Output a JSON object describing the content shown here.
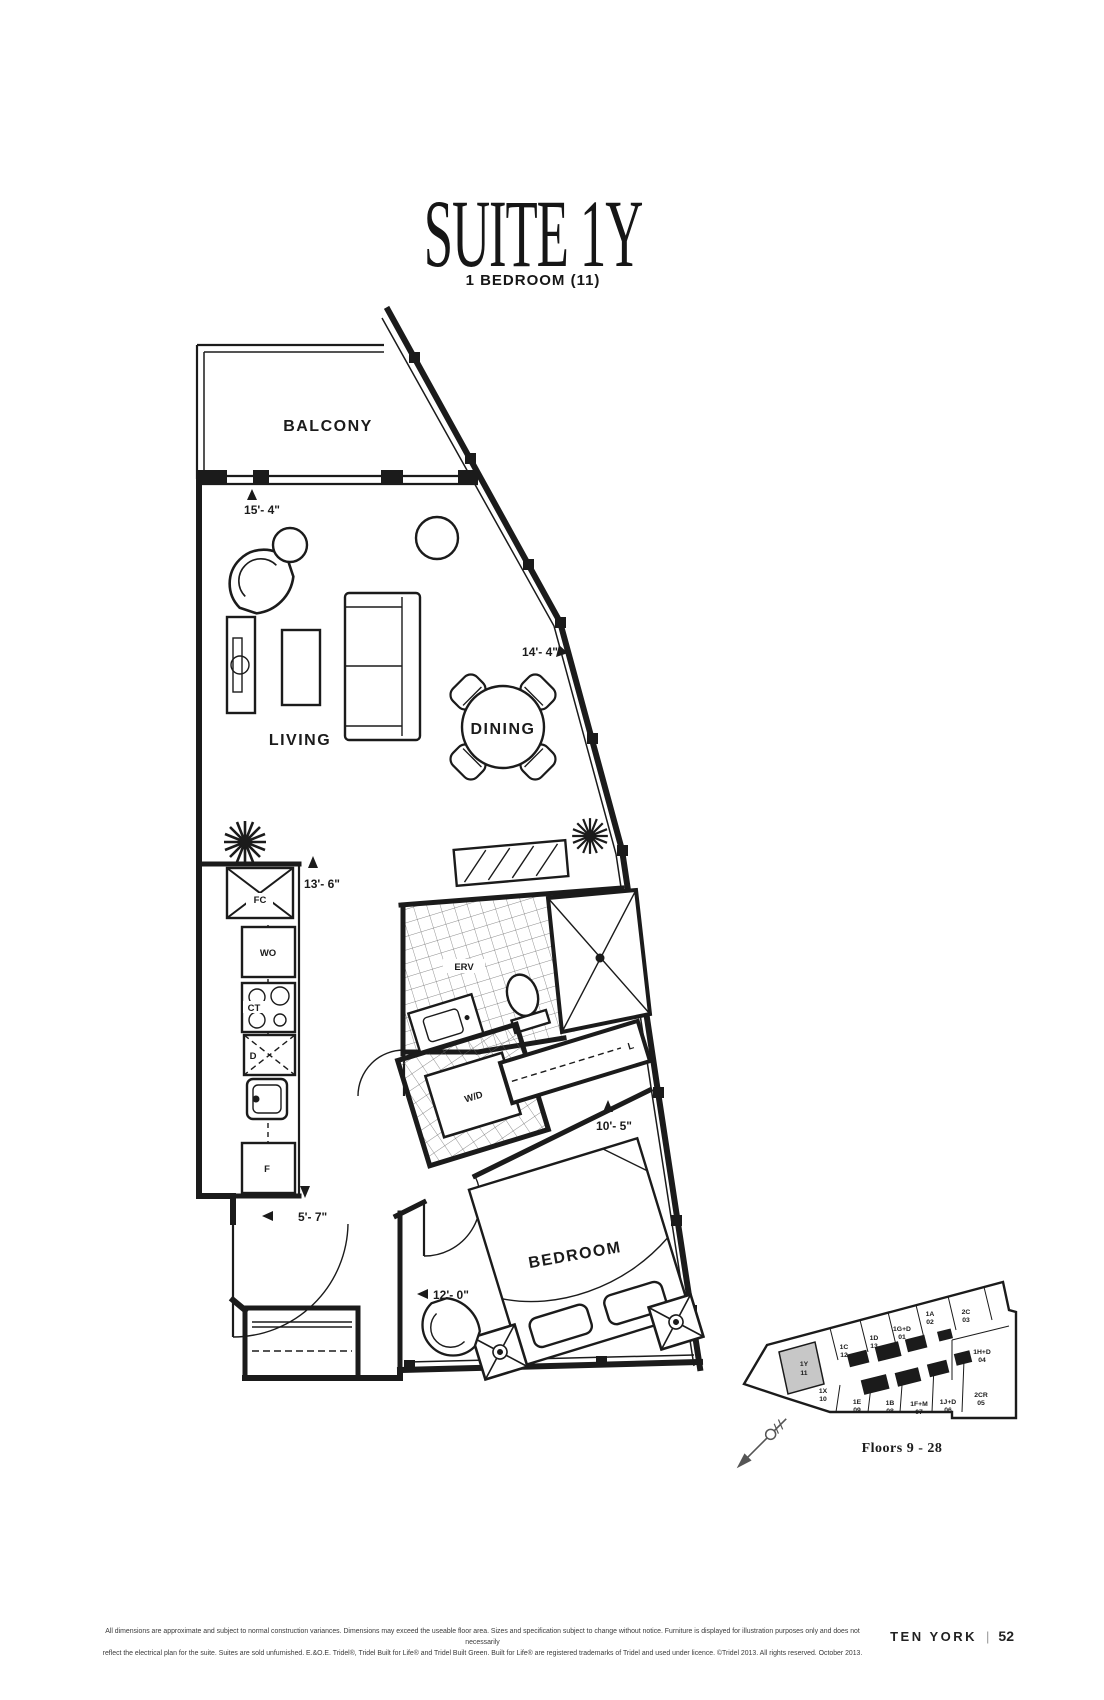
{
  "page": {
    "title": "SUITE 1Y",
    "subtitle": "1 BEDROOM (11)"
  },
  "rooms": {
    "balcony": "BALCONY",
    "living": "LIVING",
    "dining": "DINING",
    "bedroom": "BEDROOM"
  },
  "fixtures": {
    "fan_coil": "FC",
    "wall_oven": "WO",
    "cooktop": "CT",
    "dishwasher": "D",
    "fridge": "F",
    "erv": "ERV",
    "washer_dryer": "W/D",
    "linen": "L"
  },
  "dimensions": {
    "balcony_width": "15'- 4\"",
    "dining_wall": "14'- 4\"",
    "kitchen_run": "13'- 6\"",
    "bedroom_depth": "10'- 5\"",
    "foyer_width": "5'- 7\"",
    "bedroom_width": "12'- 0\""
  },
  "keyplan": {
    "caption": "Floors 9 - 28",
    "cells": [
      {
        "label": "1C",
        "num": "12"
      },
      {
        "label": "1D",
        "num": "13"
      },
      {
        "label": "1G+D",
        "num": "01"
      },
      {
        "label": "1A",
        "num": "02"
      },
      {
        "label": "2C",
        "num": "03"
      },
      {
        "label": "1H+D",
        "num": "04"
      },
      {
        "label": "2CR",
        "num": "05"
      },
      {
        "label": "1J+D",
        "num": "06"
      },
      {
        "label": "1F+M",
        "num": "07"
      },
      {
        "label": "1B",
        "num": "08"
      },
      {
        "label": "1E",
        "num": "09"
      },
      {
        "label": "1X",
        "num": "10"
      },
      {
        "label": "1Y",
        "num": "11"
      }
    ],
    "highlight_color": "#c7c7c7"
  },
  "footer": {
    "line1": "All dimensions are approximate and subject to normal construction variances. Dimensions may exceed the useable floor area. Sizes and specification subject to change without notice. Furniture is displayed for illustration purposes only and does not necessarily",
    "line2": "reflect the electrical plan for the suite. Suites are sold unfurnished. E.&O.E. Tridel®, Tridel Built for Life® and Tridel Built Green. Built for Life® are registered trademarks of Tridel and used under licence. ©Tridel 2013. All rights reserved. October 2013.",
    "brand": "TEN YORK",
    "divider": "|",
    "page_number": "52"
  }
}
